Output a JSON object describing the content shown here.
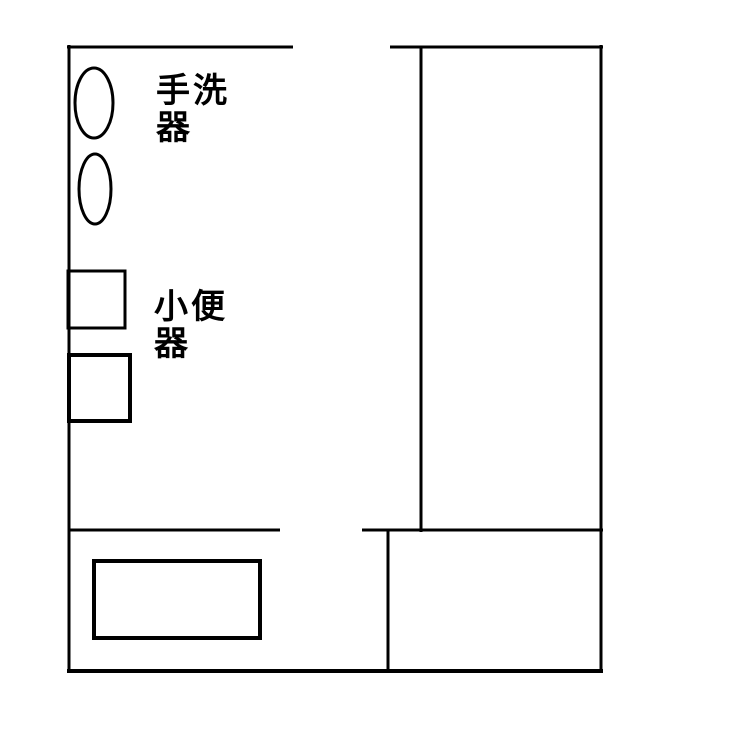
{
  "diagram": {
    "type": "floorplan",
    "width": 730,
    "height": 734,
    "background": "#ffffff",
    "stroke_color": "#000000",
    "labels": [
      {
        "name": "hand-wash-basin-label",
        "text": "手洗\n器",
        "x": 156,
        "y": 102,
        "font_size": 34,
        "line_height": 37
      },
      {
        "name": "urinal-label",
        "text": "小便\n器",
        "x": 154,
        "y": 318,
        "font_size": 34,
        "line_height": 37
      }
    ],
    "shapes": [
      {
        "name": "left-wall",
        "type": "line",
        "x1": 69,
        "y1": 45,
        "x2": 69,
        "y2": 673,
        "stroke_width": 3
      },
      {
        "name": "top-wall-left-segment",
        "type": "line",
        "x1": 67,
        "y1": 47,
        "x2": 293,
        "y2": 47,
        "stroke_width": 3
      },
      {
        "name": "top-wall-right-segment",
        "type": "line",
        "x1": 390,
        "y1": 47,
        "x2": 603,
        "y2": 47,
        "stroke_width": 3
      },
      {
        "name": "right-wall",
        "type": "line",
        "x1": 601,
        "y1": 45,
        "x2": 601,
        "y2": 673,
        "stroke_width": 3
      },
      {
        "name": "corridor-divider-wall",
        "type": "line",
        "x1": 421,
        "y1": 46,
        "x2": 421,
        "y2": 532,
        "stroke_width": 3
      },
      {
        "name": "partition-wall-left-segment",
        "type": "line",
        "x1": 68,
        "y1": 530,
        "x2": 280,
        "y2": 530,
        "stroke_width": 3
      },
      {
        "name": "partition-wall-right-segment",
        "type": "line",
        "x1": 362,
        "y1": 530,
        "x2": 603,
        "y2": 530,
        "stroke_width": 3
      },
      {
        "name": "bottom-wall",
        "type": "line",
        "x1": 67,
        "y1": 671,
        "x2": 603,
        "y2": 671,
        "stroke_width": 4
      },
      {
        "name": "bottom-right-room-left-wall",
        "type": "line",
        "x1": 388,
        "y1": 530,
        "x2": 388,
        "y2": 671,
        "stroke_width": 3
      },
      {
        "name": "wash-basin-1",
        "type": "ellipse",
        "cx": 94,
        "cy": 103,
        "rx": 19,
        "ry": 35,
        "stroke_width": 3
      },
      {
        "name": "wash-basin-2",
        "type": "ellipse",
        "cx": 95,
        "cy": 189,
        "rx": 16,
        "ry": 35,
        "stroke_width": 3
      },
      {
        "name": "urinal-1",
        "type": "rect",
        "x": 68,
        "y": 271,
        "width": 57,
        "height": 57,
        "stroke_width": 3
      },
      {
        "name": "urinal-2",
        "type": "rect",
        "x": 69,
        "y": 355,
        "width": 61,
        "height": 66,
        "stroke_width": 4
      },
      {
        "name": "bottom-left-fixture",
        "type": "rect",
        "x": 94,
        "y": 561,
        "width": 166,
        "height": 77,
        "stroke_width": 4
      }
    ]
  }
}
